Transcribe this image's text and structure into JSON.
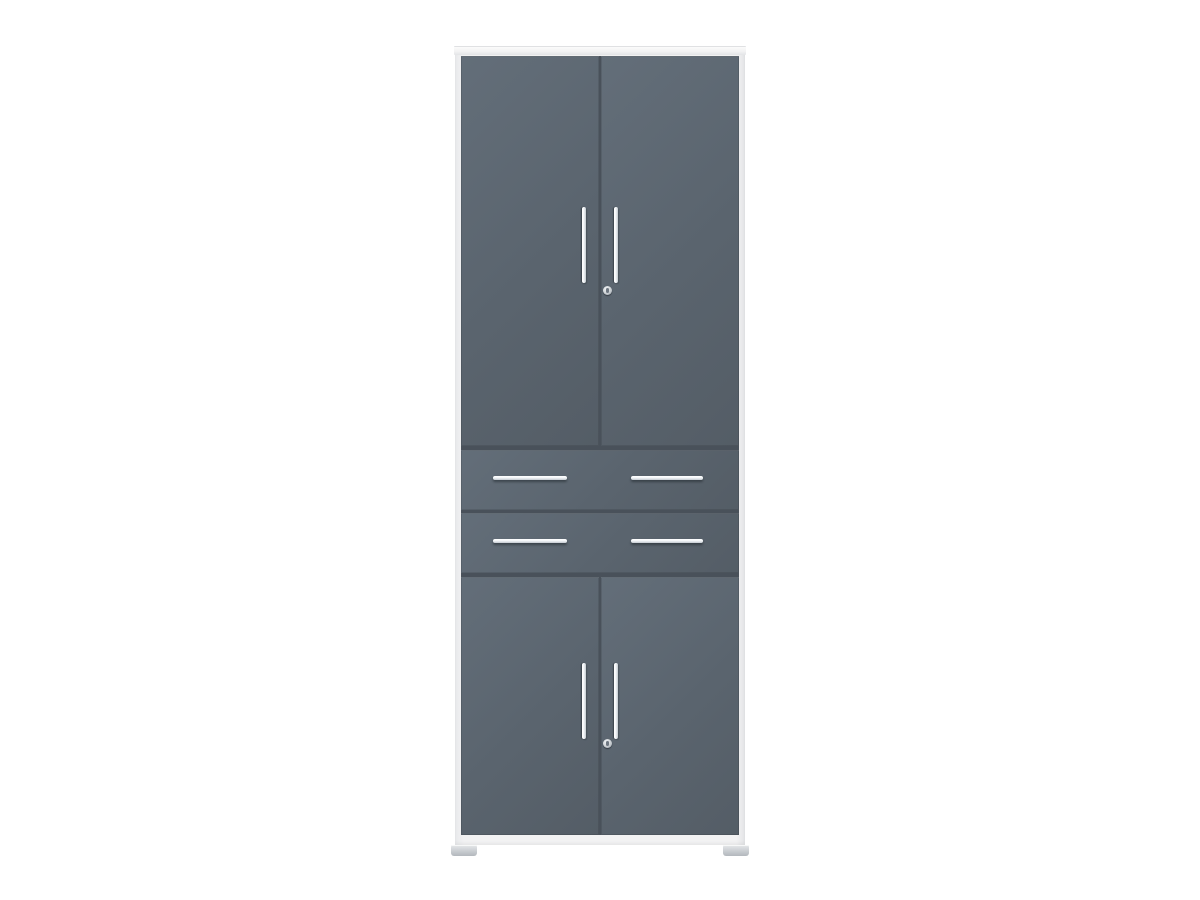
{
  "image": {
    "type": "product-photo",
    "subject": "tall storage cabinet, anthracite fronts with white frame",
    "background": "#ffffff"
  },
  "cabinet": {
    "front_finish": "anthracite gray",
    "frame_finish": "white",
    "sections_top_to_bottom": [
      "double-door-top",
      "drawer",
      "drawer",
      "double-door-bottom"
    ],
    "top_doors": 2,
    "drawers": 2,
    "bottom_doors": 2,
    "vertical_door_handles": 4,
    "horizontal_drawer_handles": 4,
    "locks": 2,
    "feet": 2
  },
  "colors": {
    "background": "#ffffff",
    "front": "#5a646e",
    "front_light": "#636e79",
    "front_dark": "#545d66",
    "frame": "#f2f2f3",
    "gap": "#49515a",
    "handle": "#f4f7f9",
    "lock_outer": "#d3d7da",
    "lock_inner": "#6e7781",
    "foot": "#c9cdd1"
  }
}
